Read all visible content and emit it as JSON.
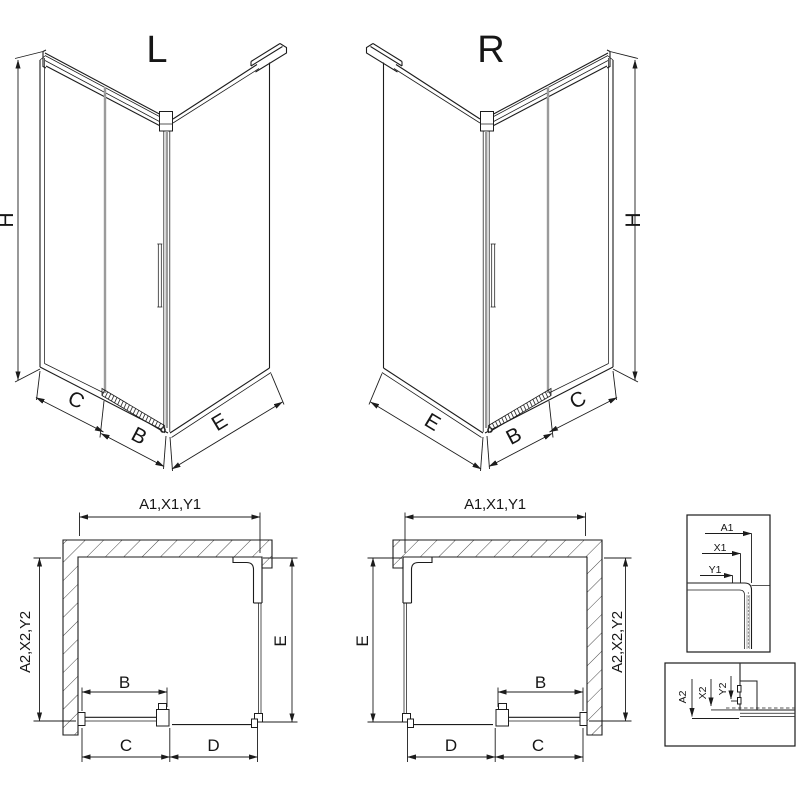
{
  "drawing": {
    "background": "#ffffff",
    "line_color": "#1c1c1c",
    "glass_edge_color": "#9b9b9b",
    "iso_left": {
      "title": "L",
      "height": "H",
      "seg_c": "C",
      "seg_b": "B",
      "seg_e": "E"
    },
    "iso_right": {
      "title": "R",
      "height": "H",
      "seg_c": "C",
      "seg_b": "B",
      "seg_e": "E"
    },
    "plan_left": {
      "top": "A1,X1,Y1",
      "side": "A2,X2,Y2",
      "depth": "E",
      "door": "B",
      "bottom_c": "C",
      "bottom_d": "D"
    },
    "plan_right": {
      "top": "A1,X1,Y1",
      "side": "A2,X2,Y2",
      "depth": "E",
      "door": "B",
      "bottom_c": "C",
      "bottom_d": "D"
    },
    "detail_wall": {
      "d1": "A1",
      "d2": "X1",
      "d3": "Y1"
    },
    "detail_floor": {
      "d1": "A2",
      "d2": "X2",
      "d3": "Y2"
    }
  }
}
